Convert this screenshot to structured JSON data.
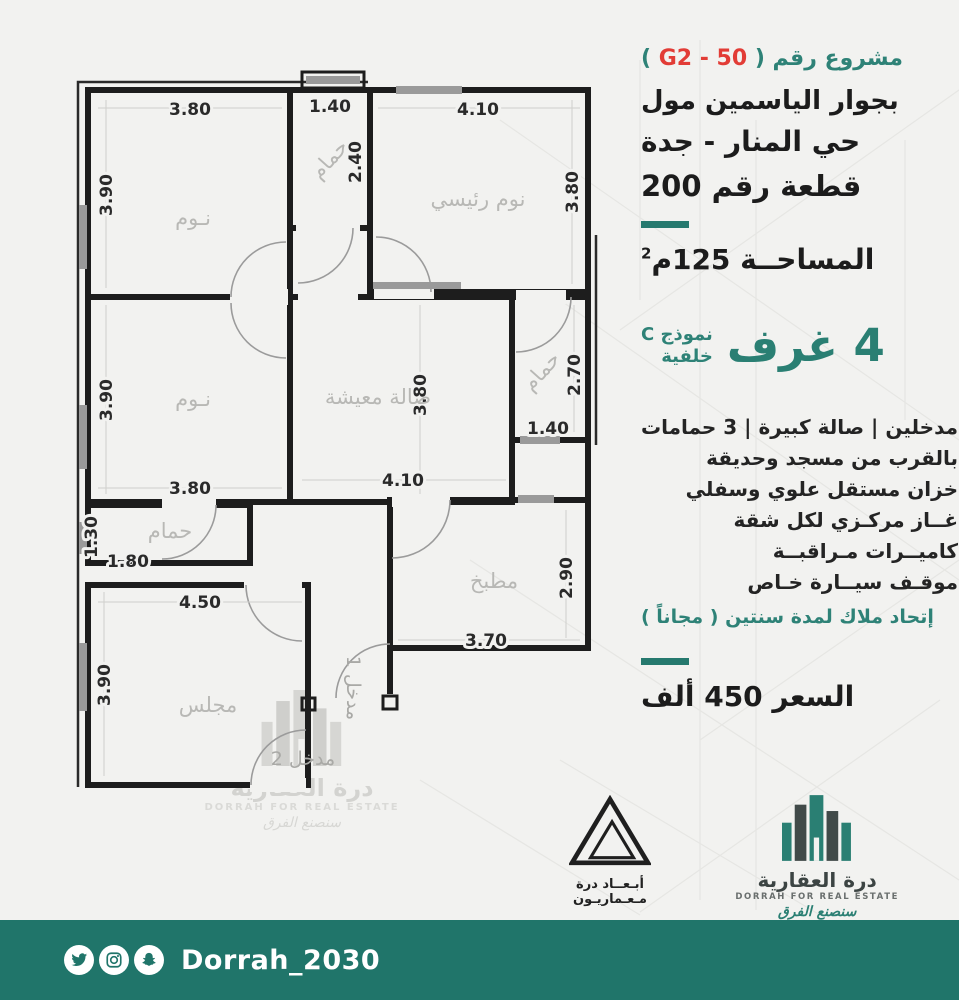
{
  "colors": {
    "background": "#f2f2f0",
    "teal_bar": "#20756a",
    "teal_text": "#2e8277",
    "teal_big": "#2a7f73",
    "red_code": "#e23c36",
    "text_black": "#1c1c1c",
    "wall": "#1d1d1d",
    "room_label_gray": "#b8b8b5"
  },
  "header": {
    "project_prefix": "مشروع رقم (",
    "project_code": "G2 - 50",
    "project_suffix": ")",
    "address_line1": "بجوار الياسمين مول",
    "address_line2": "حي المنار - جدة",
    "address_line3": "قطعة رقم 200"
  },
  "area": {
    "label": "المساحــة 125م",
    "sup": "2"
  },
  "model": {
    "rooms_big": "4 غرف",
    "model_line1": "نموذج C",
    "model_line2": "خلفية"
  },
  "features": {
    "lines": [
      "مدخلين | صالة كبيرة | 3 حمامات",
      "بالقرب من مسجد وحديقة",
      "خزان مستقل علوي وسفلي",
      "غــاز مركـزي لكل شقة",
      "كاميــرات مـراقبــة",
      "موقـف سيــارة خـاص"
    ],
    "highlight": "إتحاد ملاك لمدة سنتين ( مجاناً )"
  },
  "price": {
    "text": "السعر  450  ألف"
  },
  "plan": {
    "rooms": [
      {
        "name": "bedroom-1",
        "label": "نـوم",
        "dim_w": "3.80",
        "dim_h": "3.90"
      },
      {
        "name": "bath-top",
        "label": "حمام",
        "dim_w": "1.40",
        "dim_h": "2.40"
      },
      {
        "name": "master-bedroom",
        "label": "نوم رئيسي",
        "dim_w": "4.10",
        "dim_h": "3.80"
      },
      {
        "name": "bedroom-2",
        "label": "نـوم",
        "dim_w": "3.80",
        "dim_h": "3.90"
      },
      {
        "name": "living-room",
        "label": "صالة معيشة",
        "dim_w": "4.10",
        "dim_h": "3.80"
      },
      {
        "name": "bath-right",
        "label": "حمام",
        "dim_w": "1.40",
        "dim_h": "2.70"
      },
      {
        "name": "bath-bottom",
        "label": "حمام",
        "dim_w": "1.80",
        "dim_h": "1.30"
      },
      {
        "name": "majlis",
        "label": "مجلس",
        "dim_w": "4.50",
        "dim_h": "3.90"
      },
      {
        "name": "kitchen",
        "label": "مطبخ",
        "dim_w": "3.70",
        "dim_h": "2.90"
      }
    ],
    "entrance1": "مدخل 1",
    "entrance2": "مدخل 2"
  },
  "watermark": {
    "ar": "درة العقارية",
    "en": "DORRAH FOR REAL ESTATE",
    "tag": "سنصنع الفرق"
  },
  "logos": {
    "abaad": {
      "line1": "أبـعــاد درة",
      "line2": "مـعـماريـون"
    },
    "dorrah": {
      "ar": "درة العقارية",
      "en": "DORRAH FOR REAL ESTATE",
      "tag": "سنصنع الفرق"
    }
  },
  "footer": {
    "handle": "Dorrah_2030"
  }
}
